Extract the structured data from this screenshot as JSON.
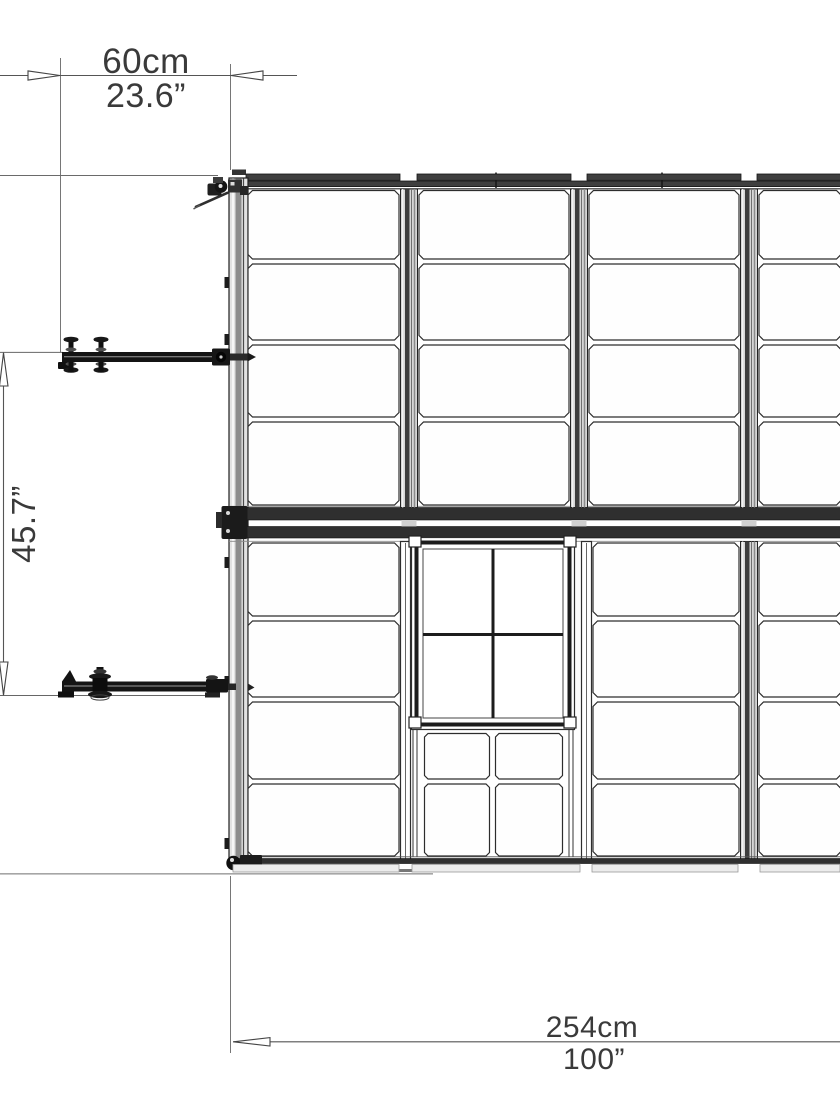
{
  "drawing": {
    "type": "greenhouse-top-view-dimension-drawing",
    "colors": {
      "line": "#2d2d2d",
      "metal_dark": "#141414",
      "frame_band": "#2f2f2f",
      "mullion_gray": "#d6d6d6",
      "text": "#3a3a3a"
    }
  },
  "dimension_labels": {
    "top_width": {
      "metric": "60cm",
      "imperial": "23.6”"
    },
    "side_depth": {
      "imperial": "45.7”"
    },
    "overall_length": {
      "metric": "254cm",
      "imperial": "100”"
    }
  }
}
